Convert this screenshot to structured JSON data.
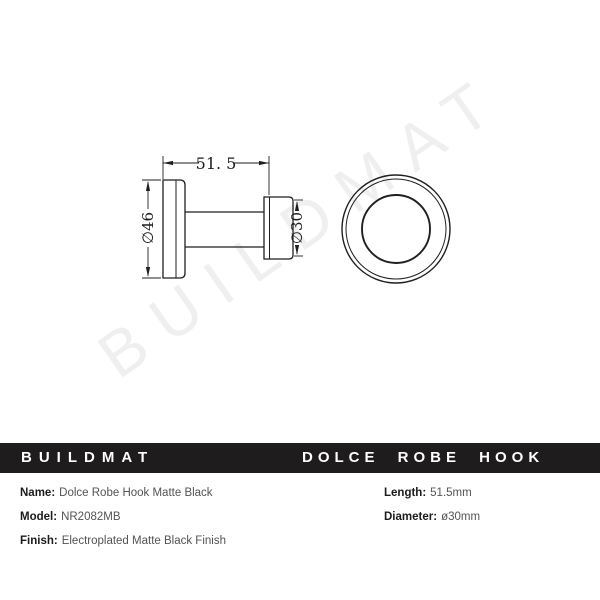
{
  "watermark": {
    "text": "BUILDMAT"
  },
  "drawing": {
    "dim_length": "51. 5",
    "dim_plate_diameter": "∅46",
    "dim_head_diameter": "∅30"
  },
  "title_bar": {
    "brand": "BUILDMAT",
    "product": "DOLCE ROBE HOOK",
    "bg_color": "#1e1c1d",
    "text_color": "#ffffff"
  },
  "specs": {
    "left": [
      {
        "label": "Name:",
        "value": "Dolce Robe Hook Matte Black"
      },
      {
        "label": "Model:",
        "value": "NR2082MB"
      },
      {
        "label": "Finish:",
        "value": "Electroplated Matte Black Finish"
      }
    ],
    "right": [
      {
        "label": "Length:",
        "value": "51.5mm"
      },
      {
        "label": "Diameter:",
        "value": "ø30mm"
      }
    ]
  },
  "colors": {
    "line": "#1f1f1f",
    "watermark": "#efefef",
    "bar_background": "#1e1c1d"
  }
}
